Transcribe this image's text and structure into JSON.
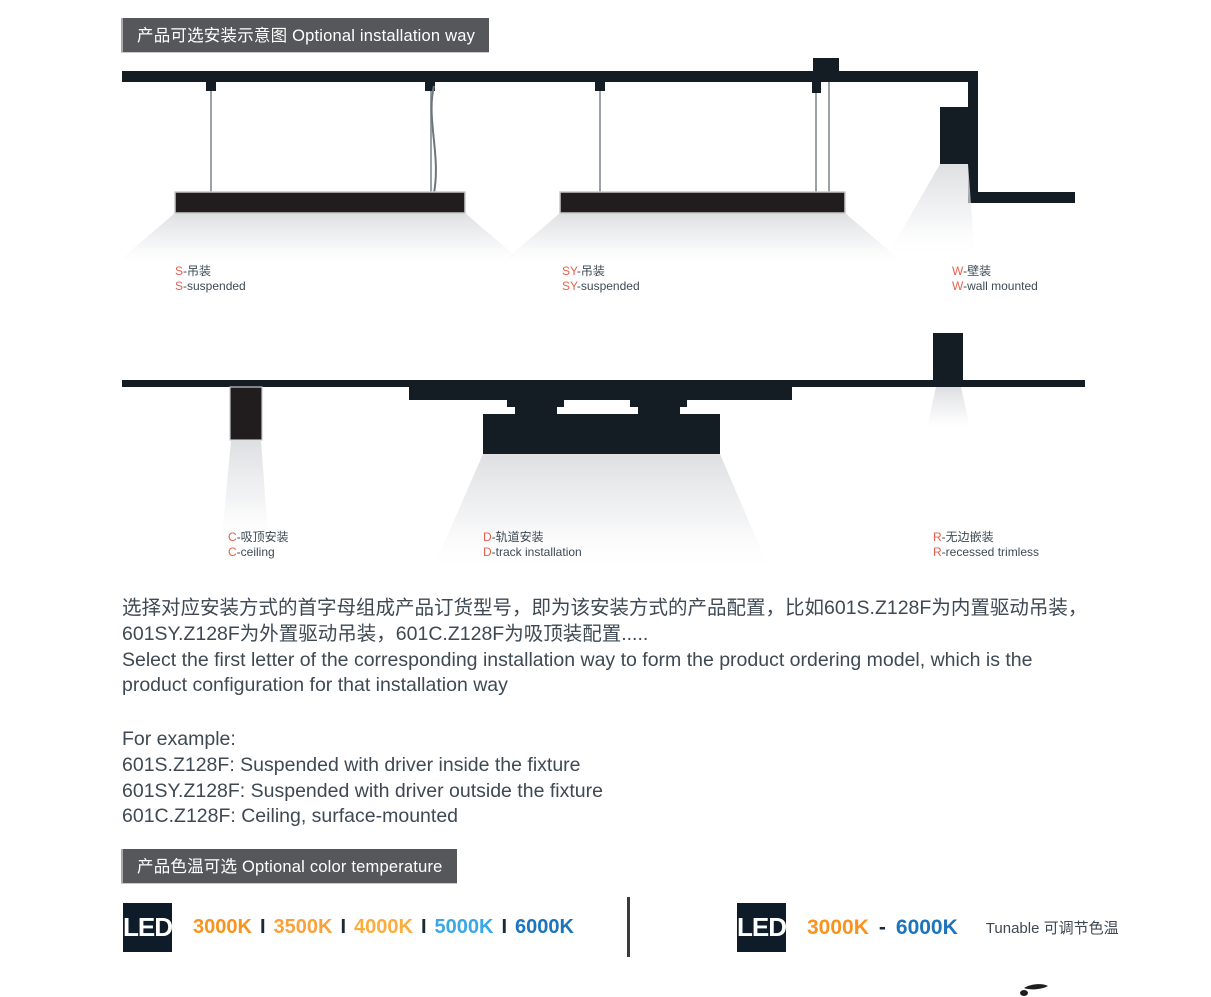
{
  "colors": {
    "accent_coral": "#E8604C",
    "structure_dark": "#141C24",
    "fixture_dark": "#211C1D",
    "badge_bg": "#56575B",
    "text_dark": "#3E4953",
    "led_badge_bg": "#0E1C29"
  },
  "installation": {
    "header": "产品可选安装示意图 Optional installation way",
    "methods": [
      {
        "code": "S",
        "zh": "-吊装",
        "en": "-suspended"
      },
      {
        "code": "SY",
        "zh": "-吊装",
        "en": "-suspended"
      },
      {
        "code": "W",
        "zh": "-壁装",
        "en": "-wall mounted"
      },
      {
        "code": "C",
        "zh": "-吸顶安装",
        "en": "-ceiling"
      },
      {
        "code": "D",
        "zh": "-轨道安装",
        "en": "-track installation"
      },
      {
        "code": "R",
        "zh": "-无边嵌装",
        "en": "-recessed trimless"
      }
    ],
    "description_zh": "选择对应安装方式的首字母组成产品订货型号，即为该安装方式的产品配置，比如601S.Z128F为内置驱动吊装，601SY.Z128F为外置驱动吊装，601C.Z128F为吸顶装配置.....",
    "description_en": "Select the first letter of the corresponding installation way to form the product ordering model, which is the product configuration for that installation way",
    "example_intro": "For example:",
    "examples": [
      "601S.Z128F: Suspended with driver inside the fixture",
      "601SY.Z128F: Suspended with driver outside the fixture",
      "601C.Z128F: Ceiling, surface-mounted"
    ]
  },
  "color_temp": {
    "header": "产品色温可选 Optional color temperature",
    "led_label": "LED",
    "separator": "I",
    "fixed": [
      {
        "label": "3000K",
        "color": "#F7941E"
      },
      {
        "label": "3500K",
        "color": "#F9A23B"
      },
      {
        "label": "4000K",
        "color": "#FBAE3E"
      },
      {
        "label": "5000K",
        "color": "#3AA7E8"
      },
      {
        "label": "6000K",
        "color": "#1C75BC"
      }
    ],
    "tunable": {
      "from": "3000K",
      "from_color": "#F7941E",
      "dash": "-",
      "to": "6000K",
      "to_color": "#1C75BC",
      "note": "Tunable 可调节色温"
    }
  }
}
